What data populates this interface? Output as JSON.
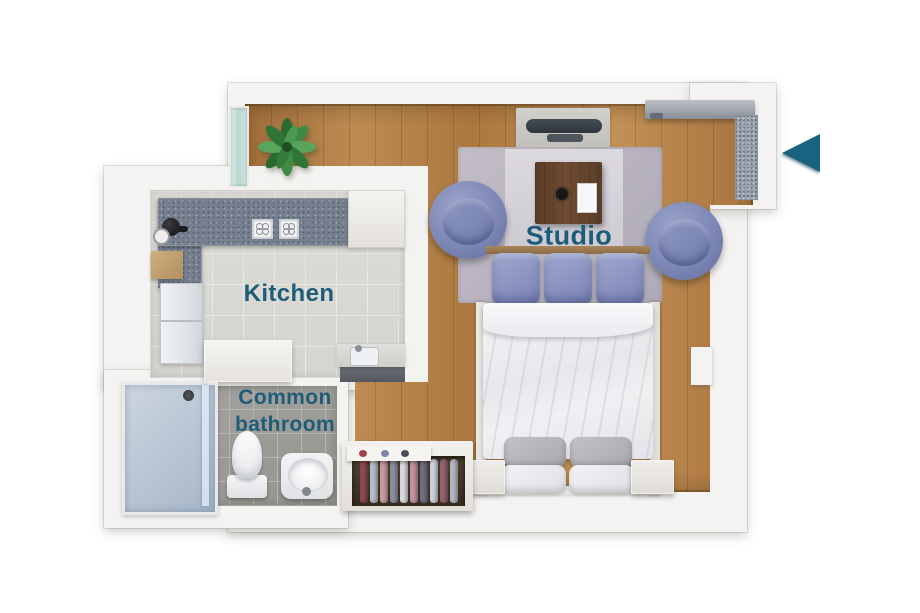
{
  "page": {
    "type": "floor-plan",
    "background": "#ffffff"
  },
  "rooms": {
    "studio": {
      "label": "Studio",
      "floor": "wood"
    },
    "kitchen": {
      "label": "Kitchen",
      "floor": "tile"
    },
    "bathroom": {
      "label_line1": "Common",
      "label_line2": "bathroom",
      "floor": "tile"
    }
  },
  "entrance": {
    "indicator": "entrance-arrow-left-icon",
    "points_to": "studio entrance door"
  },
  "palette": {
    "label_text": "#1e5d79",
    "arrow": "#1a6380",
    "wall": "#f4f3f1",
    "wood_floor": "#b28048",
    "kitchen_floor": "#d9d7d2",
    "bathroom_floor": "#9d9b97",
    "upholstery": "#8a93c0",
    "counter": "#77808f",
    "rug": "#b7b2bc"
  },
  "furniture": {
    "studio": [
      "potted-plant",
      "tv-console",
      "entrance-door",
      "doormat",
      "area-rug",
      "desk",
      "armchair",
      "armchair",
      "double-bed",
      "nightstand",
      "nightstand",
      "open-wardrobe",
      "window"
    ],
    "kitchen": [
      "l-countertop",
      "sink-faucet",
      "cooktop",
      "refrigerator",
      "island-counter",
      "cutting-board",
      "wall-cabinet",
      "sink-counter"
    ],
    "bathroom": [
      "shower-cabin",
      "toilet",
      "washbasin"
    ]
  },
  "wardrobe": {
    "clothes_colors": [
      "#8e4a52",
      "#b9bdc9",
      "#c79ba3",
      "#8b8f9c",
      "#dadade",
      "#c293a0",
      "#6b7083",
      "#cdd1da",
      "#94626e",
      "#b2b6c2"
    ]
  }
}
